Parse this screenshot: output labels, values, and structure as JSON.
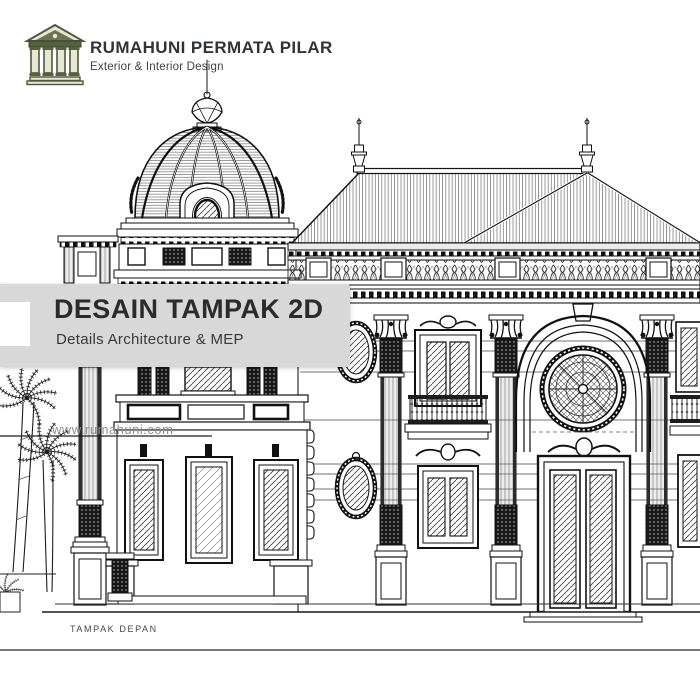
{
  "header": {
    "brand_name": "RUMAHUNI PERMATA PILAR",
    "brand_tagline": "Exterior & Interior Design",
    "logo_icon": "classical-temple-icon",
    "logo_color": "#55603f"
  },
  "banner": {
    "title": "DESAIN TAMPAK 2D",
    "subtitle": "Details Architecture & MEP",
    "bg_color": "#d8d8d8",
    "title_color": "#2b2b2b",
    "tab_color": "#ffffff"
  },
  "watermark": {
    "url_text": "www.rumahuni.com"
  },
  "drawing": {
    "caption": "TAMPAK DEPAN",
    "type": "architectural front elevation, black and white CAD line art",
    "ink_color": "#1c1c1c",
    "features": [
      "ribbed dome with crown finial",
      "hipped metal roof with two spires",
      "balustrade parapet",
      "corinthian columns",
      "rose window over grand arched entry",
      "oval medallion windows",
      "single-story left wing with three windows",
      "two palm trees",
      "ground line and dimension line"
    ]
  }
}
